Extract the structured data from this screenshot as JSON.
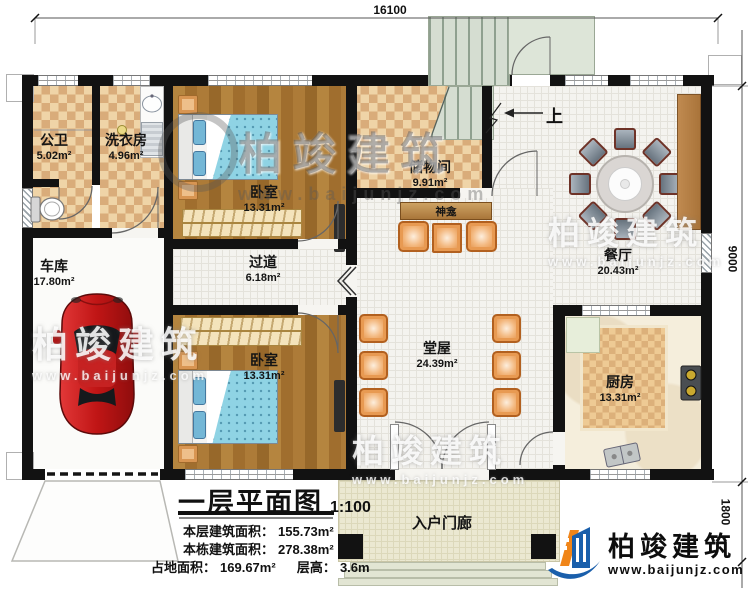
{
  "dimensions": {
    "top": "16100",
    "right_upper": "9000",
    "right_lower": "1800"
  },
  "rooms": {
    "bathroom": {
      "name": "公卫",
      "area": "5.02m²"
    },
    "laundry": {
      "name": "洗衣房",
      "area": "4.96m²"
    },
    "bedroom_top": {
      "name": "卧室",
      "area": "13.31m²"
    },
    "storage": {
      "name": "储物间",
      "area": "9.91m²"
    },
    "dining": {
      "name": "餐厅",
      "area": "20.43m²"
    },
    "garage": {
      "name": "车库",
      "area": "17.80m²"
    },
    "corridor": {
      "name": "过道",
      "area": "6.18m²"
    },
    "bedroom_bottom": {
      "name": "卧室",
      "area": "13.31m²"
    },
    "hall": {
      "name": "堂屋",
      "area": "24.39m²"
    },
    "kitchen": {
      "name": "厨房",
      "area": "13.31m²"
    },
    "porch": {
      "name": "入户门廊"
    },
    "shrine": {
      "name": "神龛"
    }
  },
  "stairs": {
    "up_label": "上"
  },
  "title_block": {
    "title": "一层平面图",
    "scale": "1:100",
    "floor_area_label": "本层建筑面积：",
    "floor_area_value": "155.73m²",
    "total_area_label": "本栋建筑面积：",
    "total_area_value": "278.38m²",
    "land_area_label": "占地面积：",
    "land_area_value": "169.67m²",
    "storey_height_label": "层高：",
    "storey_height_value": "3.6m"
  },
  "brand": {
    "name": "柏竣建筑",
    "website": "www.baijunjz.com"
  },
  "watermark": {
    "name": "柏竣建筑",
    "website": "www.baijunjz.com"
  },
  "colors": {
    "wall": "#121212",
    "checker_light": "#efd4a7",
    "checker_dark": "#d9ac7a",
    "wood": "#a06e2e",
    "accent_orange": "#e08b42",
    "brand_blue": "#1a5fab",
    "brand_orange": "#f08519"
  }
}
